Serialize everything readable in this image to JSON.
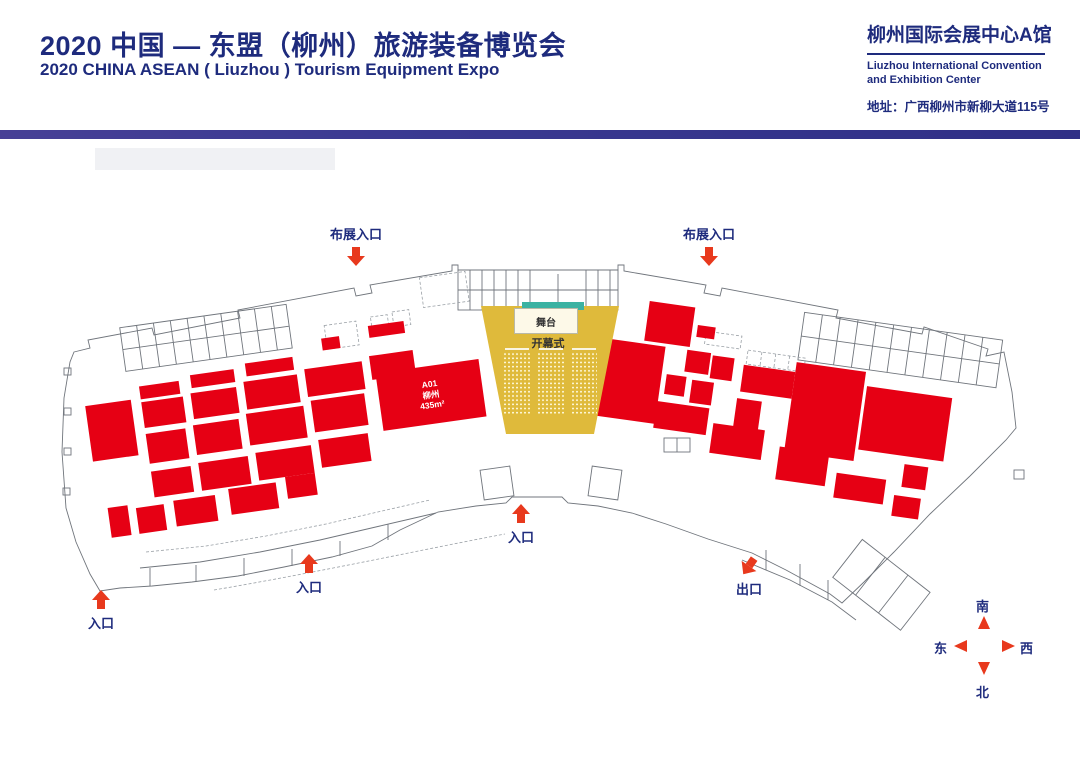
{
  "header": {
    "title_cn": "2020 中国 — 东盟（柳州）旅游装备博览会",
    "title_en": "2020 CHINA ASEAN ( Liuzhou ) Tourism Equipment Expo",
    "venue_cn": "柳州国际会展中心A馆",
    "venue_en_line1": "Liuzhou International Convention",
    "venue_en_line2": "and Exhibition Center",
    "address": "地址：广西柳州市新柳大道115号"
  },
  "colors": {
    "navy": "#1e2b7d",
    "booth_red": "#e60014",
    "arrow_red": "#e8391d",
    "ceremony_yellow": "#dfba3b",
    "stage_teal": "#3bb2a2",
    "stage_cream": "#fdf9e8",
    "outline_gray": "#70757c"
  },
  "stage": {
    "stage_label": "舞台",
    "ceremony_label": "开幕式"
  },
  "markers": [
    {
      "label": "布展入口"
    },
    {
      "label": "布展入口"
    },
    {
      "label": "入口"
    },
    {
      "label": "入口"
    },
    {
      "label": "入口"
    },
    {
      "label": "出口"
    }
  ],
  "compass": {
    "south": "南",
    "north": "北",
    "east": "东",
    "west": "西"
  },
  "floorplan": {
    "left_booths": [
      {
        "r": [
          85,
          72,
          40,
          13
        ]
      },
      {
        "r": [
          137,
          68,
          44,
          13
        ]
      },
      {
        "r": [
          193,
          64,
          48,
          13
        ]
      },
      {
        "r": [
          320,
          44,
          36,
          12
        ]
      },
      {
        "r": [
          272,
          50,
          18,
          12
        ]
      },
      {
        "r": [
          85,
          88,
          42,
          26
        ]
      },
      {
        "r": [
          135,
          86,
          46,
          26
        ]
      },
      {
        "r": [
          189,
          82,
          54,
          28
        ]
      },
      {
        "r": [
          251,
          78,
          58,
          28
        ]
      },
      {
        "r": [
          317,
          74,
          44,
          24
        ]
      },
      {
        "r": [
          29,
          84,
          46,
          56
        ],
        "name": "booth-large-square"
      },
      {
        "r": [
          85,
          120,
          40,
          30
        ]
      },
      {
        "r": [
          133,
          118,
          46,
          30
        ]
      },
      {
        "r": [
          187,
          114,
          58,
          32
        ]
      },
      {
        "r": [
          253,
          110,
          54,
          32
        ]
      },
      {
        "r": [
          321,
          92,
          104,
          58
        ],
        "name": "booth-a01-liuzhou",
        "label": [
          "A01",
          "柳州",
          "435m²"
        ]
      },
      {
        "r": [
          85,
          158,
          40,
          26
        ]
      },
      {
        "r": [
          133,
          156,
          50,
          28
        ]
      },
      {
        "r": [
          191,
          154,
          56,
          28
        ]
      },
      {
        "r": [
          255,
          150,
          50,
          28
        ]
      },
      {
        "r": [
          37,
          188,
          20,
          30
        ]
      },
      {
        "r": [
          65,
          192,
          28,
          26
        ]
      },
      {
        "r": [
          103,
          190,
          42,
          26
        ]
      },
      {
        "r": [
          159,
          186,
          48,
          26
        ]
      },
      {
        "r": [
          217,
          182,
          30,
          22
        ]
      }
    ],
    "right_booths": [
      {
        "r": [
          44,
          28,
          46,
          40
        ]
      },
      {
        "r": [
          8,
          71,
          58,
          78
        ],
        "name": "booth-a73"
      },
      {
        "r": [
          95,
          45,
          18,
          12
        ]
      },
      {
        "r": [
          88,
          71,
          24,
          22
        ]
      },
      {
        "r": [
          114,
          73,
          22,
          23
        ]
      },
      {
        "r": [
          146,
          78,
          52,
          27
        ]
      },
      {
        "r": [
          71,
          98,
          20,
          20
        ]
      },
      {
        "r": [
          97,
          100,
          22,
          23
        ]
      },
      {
        "r": [
          144,
          112,
          25,
          30
        ]
      },
      {
        "r": [
          198,
          68,
          70,
          90
        ],
        "name": "booth-large-a"
      },
      {
        "r": [
          271,
          82,
          86,
          64
        ],
        "name": "booth-large-b"
      },
      {
        "r": [
          65,
          126,
          53,
          27
        ]
      },
      {
        "r": [
          124,
          140,
          52,
          30
        ]
      },
      {
        "r": [
          193,
          154,
          50,
          33
        ]
      },
      {
        "r": [
          253,
          172,
          50,
          25
        ]
      },
      {
        "r": [
          313,
          186,
          27,
          21
        ]
      },
      {
        "r": [
          319,
          154,
          24,
          23
        ]
      }
    ]
  }
}
